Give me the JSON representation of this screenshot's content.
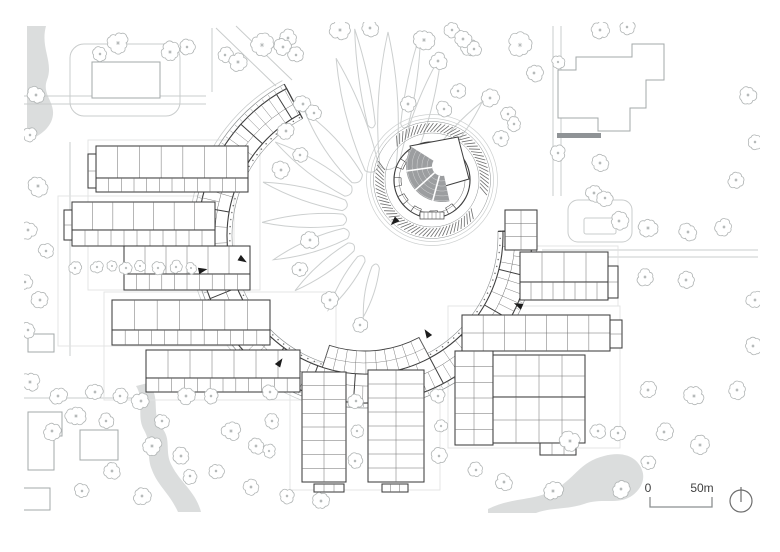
{
  "drawing": {
    "kind": "architectural-site-plan",
    "scalebar": {
      "zero_label": "0",
      "max_label": "50m"
    },
    "north_arrow": {
      "cx": 741,
      "cy": 501,
      "r": 11
    },
    "colors": {
      "line_dark": "#3f3f3f",
      "line_mid": "#6e6e6e",
      "line_soft": "#8b8f90",
      "context": "#a3a8aa",
      "road": "#c9cccc",
      "petal": "#cccfcf",
      "water": "#dbdddd",
      "seating": "#9c9ea0",
      "arrow": "#1c1c1c",
      "tree": "#b2b6b6",
      "yard": "#e1e3e3",
      "dark_bar": "#8f9396",
      "label": "#3f3f3f"
    },
    "clip": [
      24,
      22,
      736,
      494
    ],
    "water_paths": [
      "M27,26 L46,26 C40,48 54,62 47,80 C41,96 59,104 51,122 C45,134 33,138 28,141 L27,141 Z",
      "M148,383 C162,398 150,412 162,428 C172,440 164,452 172,466 C180,482 196,492 201,512 L178,512 C170,494 158,486 152,470 C146,456 152,444 144,430 C136,416 145,400 136,386 Z",
      "M488,509 C512,497 536,501 556,489 C576,477 580,462 604,456 C622,451 637,456 642,470 C646,480 640,492 628,498 C616,504 600,498 584,504 C566,510 552,507 536,513 L488,513 Z"
    ],
    "roads": [
      "M24,96 H206",
      "M24,104 H206",
      "M212,28 V92",
      "M216,28 L276,86",
      "M236,26 L292,80",
      "M553,26 V196",
      "M561,26 V196",
      "M542,250 H758",
      "M542,257 H758",
      "M70,142 V356",
      "M24,398 H134"
    ],
    "road_loops": [
      [
        70,
        44,
        110,
        72,
        14
      ],
      [
        568,
        200,
        64,
        42,
        10
      ],
      [
        584,
        218,
        32,
        16,
        2
      ]
    ],
    "yards": [
      [
        88,
        140,
        172,
        150
      ],
      [
        58,
        196,
        176,
        150
      ],
      [
        104,
        292,
        232,
        108
      ],
      [
        290,
        362,
        150,
        128
      ],
      [
        448,
        306,
        172,
        142
      ],
      [
        514,
        246,
        104,
        60
      ]
    ],
    "context_buildings": [
      "M92,62 h68 v36 h-68 Z",
      "M558,96 L558,70 L576,70 L576,57 L632,57 L632,44 L664,44 L664,80 L646,80 L646,108 L630,108 L630,131 L598,131 L598,118 L558,118 Z",
      "M28,412 H62 V436 H54 V470 H28 Z",
      "M80,430 h38 v30 h-38 Z",
      "M20,488 h30 v22 h-30 Z",
      "M28,334 h26 v18 h-26 Z"
    ],
    "dark_bar_rect": [
      557,
      133,
      44,
      5
    ],
    "ring": {
      "cx": 365,
      "cy": 236,
      "r_in": 138,
      "r_mid": 150,
      "r_out": 167,
      "r_arcade_in": 133,
      "r_arcade_out": 172,
      "r_walk": 176,
      "a0": -2,
      "a1": 242,
      "south_rooms": {
        "r_in": 115,
        "r_out": 138,
        "a0": 62,
        "a1": 108
      }
    },
    "petal_origin": [
      388,
      218
    ],
    "petals": [
      [
        270,
        52,
        186,
        15
      ],
      [
        288,
        58,
        172,
        12
      ],
      [
        252,
        52,
        168,
        13
      ],
      [
        309,
        72,
        150,
        9
      ],
      [
        232,
        50,
        135,
        12
      ],
      [
        214,
        48,
        136,
        11
      ],
      [
        196,
        46,
        130,
        10
      ],
      [
        178,
        45,
        126,
        10
      ],
      [
        160,
        45,
        122,
        10
      ],
      [
        142,
        47,
        118,
        9
      ],
      [
        123,
        49,
        110,
        8
      ],
      [
        104,
        51,
        102,
        7
      ],
      [
        260,
        95,
        192,
        7
      ],
      [
        280,
        95,
        188,
        7
      ]
    ],
    "theater": {
      "cx": 432,
      "cy": 180,
      "r_bldg": 38,
      "r_inner": 33,
      "hatch_r1": 48,
      "hatch_r2": 57,
      "hatch_step": 4,
      "hatch_gaps": [
        [
          198,
          226
        ],
        [
          16,
          36
        ]
      ],
      "ring_paths_r": [
        61.5,
        65.5
      ],
      "stage_path": "M410,146 L458,137 L469,179 L421,193 Z",
      "fan": {
        "cx": 442,
        "cy": 166,
        "r1": 10,
        "r2": 36,
        "a0": 78,
        "a1": 212,
        "aisles": [
          105,
          138,
          172
        ],
        "rows": [
          15,
          20,
          25,
          30,
          35
        ]
      },
      "perimeter_rooms": [
        50,
        80,
        110,
        140,
        170,
        200,
        230,
        262
      ],
      "stair_rect": [
        420,
        212,
        24,
        7
      ]
    },
    "wings": [
      [
        96,
        146,
        152,
        32,
        7,
        1
      ],
      [
        96,
        178,
        152,
        14,
        12,
        1
      ],
      [
        88,
        154,
        8,
        34,
        1,
        2
      ],
      [
        72,
        202,
        143,
        28,
        7,
        1
      ],
      [
        72,
        230,
        143,
        16,
        11,
        1
      ],
      [
        64,
        210,
        8,
        30,
        1,
        2
      ],
      [
        124,
        246,
        126,
        28,
        6,
        1
      ],
      [
        124,
        274,
        126,
        16,
        10,
        1
      ],
      [
        112,
        300,
        158,
        30,
        7,
        1
      ],
      [
        112,
        330,
        158,
        15,
        12,
        1
      ],
      [
        146,
        350,
        154,
        28,
        7,
        1
      ],
      [
        146,
        378,
        154,
        14,
        12,
        1
      ],
      [
        302,
        372,
        44,
        110,
        2,
        8
      ],
      [
        368,
        370,
        56,
        112,
        2,
        8
      ],
      [
        314,
        484,
        30,
        8,
        3,
        1
      ],
      [
        382,
        484,
        26,
        8,
        3,
        1
      ],
      [
        520,
        252,
        88,
        30,
        4,
        1
      ],
      [
        520,
        282,
        88,
        18,
        8,
        1
      ],
      [
        608,
        266,
        10,
        32,
        1,
        2
      ],
      [
        462,
        315,
        148,
        36,
        7,
        2
      ],
      [
        610,
        320,
        12,
        28,
        1,
        2
      ],
      [
        455,
        351,
        38,
        94,
        2,
        6
      ],
      [
        493,
        355,
        92,
        42,
        4,
        2
      ],
      [
        493,
        397,
        92,
        46,
        4,
        2
      ],
      [
        540,
        443,
        36,
        12,
        3,
        1
      ],
      [
        505,
        210,
        32,
        40,
        2,
        3
      ]
    ],
    "arrows": [
      [
        203,
        270,
        -12
      ],
      [
        280,
        362,
        -56
      ],
      [
        427,
        333,
        237
      ],
      [
        518,
        305,
        204
      ],
      [
        394,
        222,
        135
      ],
      [
        243,
        260,
        32
      ]
    ],
    "trees": [
      [
        118,
        43,
        10
      ],
      [
        100,
        54,
        7
      ],
      [
        170,
        52,
        9
      ],
      [
        187,
        47,
        7
      ],
      [
        225,
        55,
        7
      ],
      [
        238,
        62,
        9
      ],
      [
        262,
        45,
        11
      ],
      [
        288,
        38,
        8
      ],
      [
        340,
        30,
        9
      ],
      [
        370,
        28,
        8
      ],
      [
        424,
        40,
        10
      ],
      [
        452,
        30,
        7
      ],
      [
        470,
        47,
        8
      ],
      [
        520,
        45,
        11
      ],
      [
        534,
        73,
        8
      ],
      [
        558,
        62,
        6
      ],
      [
        600,
        30,
        8
      ],
      [
        627,
        27,
        7
      ],
      [
        748,
        95,
        8
      ],
      [
        755,
        142,
        7
      ],
      [
        736,
        180,
        8
      ],
      [
        558,
        153,
        7
      ],
      [
        600,
        163,
        8
      ],
      [
        594,
        193,
        8
      ],
      [
        605,
        198,
        7
      ],
      [
        619,
        221,
        8
      ],
      [
        648,
        228,
        9
      ],
      [
        688,
        232,
        8
      ],
      [
        724,
        227,
        8
      ],
      [
        645,
        277,
        8
      ],
      [
        686,
        280,
        8
      ],
      [
        648,
        390,
        8
      ],
      [
        694,
        396,
        9
      ],
      [
        737,
        390,
        8
      ],
      [
        755,
        300,
        8
      ],
      [
        753,
        346,
        8
      ],
      [
        664,
        432,
        8
      ],
      [
        700,
        445,
        9
      ],
      [
        283,
        47,
        8
      ],
      [
        296,
        55,
        7
      ],
      [
        303,
        104,
        8
      ],
      [
        314,
        113,
        7
      ],
      [
        286,
        131,
        8
      ],
      [
        281,
        170,
        8
      ],
      [
        300,
        155,
        7
      ],
      [
        408,
        104,
        8
      ],
      [
        438,
        61,
        8
      ],
      [
        463,
        39,
        8
      ],
      [
        474,
        49,
        7
      ],
      [
        444,
        109,
        7
      ],
      [
        458,
        91,
        7
      ],
      [
        490,
        98,
        8
      ],
      [
        508,
        114,
        7
      ],
      [
        501,
        138,
        8
      ],
      [
        514,
        124,
        7
      ],
      [
        310,
        240,
        8
      ],
      [
        300,
        270,
        7
      ],
      [
        330,
        300,
        8
      ],
      [
        360,
        325,
        7
      ],
      [
        36,
        95,
        8
      ],
      [
        30,
        135,
        7
      ],
      [
        38,
        186,
        9
      ],
      [
        28,
        230,
        8
      ],
      [
        46,
        251,
        7
      ],
      [
        75,
        268,
        6
      ],
      [
        97,
        267,
        6
      ],
      [
        112,
        266,
        5
      ],
      [
        126,
        268,
        6
      ],
      [
        140,
        266,
        5
      ],
      [
        158,
        268,
        6
      ],
      [
        176,
        267,
        6
      ],
      [
        191,
        268,
        5
      ],
      [
        25,
        282,
        7
      ],
      [
        40,
        300,
        8
      ],
      [
        28,
        330,
        7
      ],
      [
        30,
        382,
        9
      ],
      [
        58,
        396,
        8
      ],
      [
        95,
        392,
        8
      ],
      [
        120,
        396,
        7
      ],
      [
        76,
        416,
        9
      ],
      [
        52,
        431,
        8
      ],
      [
        106,
        421,
        7
      ],
      [
        141,
        401,
        8
      ],
      [
        162,
        421,
        7
      ],
      [
        186,
        396,
        8
      ],
      [
        211,
        396,
        7
      ],
      [
        152,
        446,
        9
      ],
      [
        181,
        456,
        8
      ],
      [
        231,
        431,
        9
      ],
      [
        256,
        446,
        8
      ],
      [
        216,
        471,
        7
      ],
      [
        251,
        487,
        8
      ],
      [
        112,
        471,
        8
      ],
      [
        82,
        491,
        7
      ],
      [
        142,
        496,
        8
      ],
      [
        190,
        476,
        7
      ],
      [
        287,
        496,
        7
      ],
      [
        321,
        501,
        8
      ],
      [
        270,
        392,
        7
      ],
      [
        272,
        421,
        7
      ],
      [
        269,
        451,
        6
      ],
      [
        356,
        401,
        7
      ],
      [
        357,
        431,
        6
      ],
      [
        355,
        461,
        7
      ],
      [
        438,
        396,
        7
      ],
      [
        441,
        426,
        6
      ],
      [
        439,
        456,
        7
      ],
      [
        570,
        441,
        9
      ],
      [
        598,
        431,
        7
      ],
      [
        618,
        433,
        7
      ],
      [
        553,
        491,
        9
      ],
      [
        621,
        489,
        8
      ],
      [
        648,
        463,
        7
      ],
      [
        476,
        470,
        7
      ],
      [
        504,
        482,
        8
      ]
    ],
    "scalebar_geom": {
      "x1": 650,
      "x2": 712,
      "y": 507,
      "tick": 10,
      "zero_x": 648,
      "label_x": 702,
      "text_y": 492
    }
  }
}
